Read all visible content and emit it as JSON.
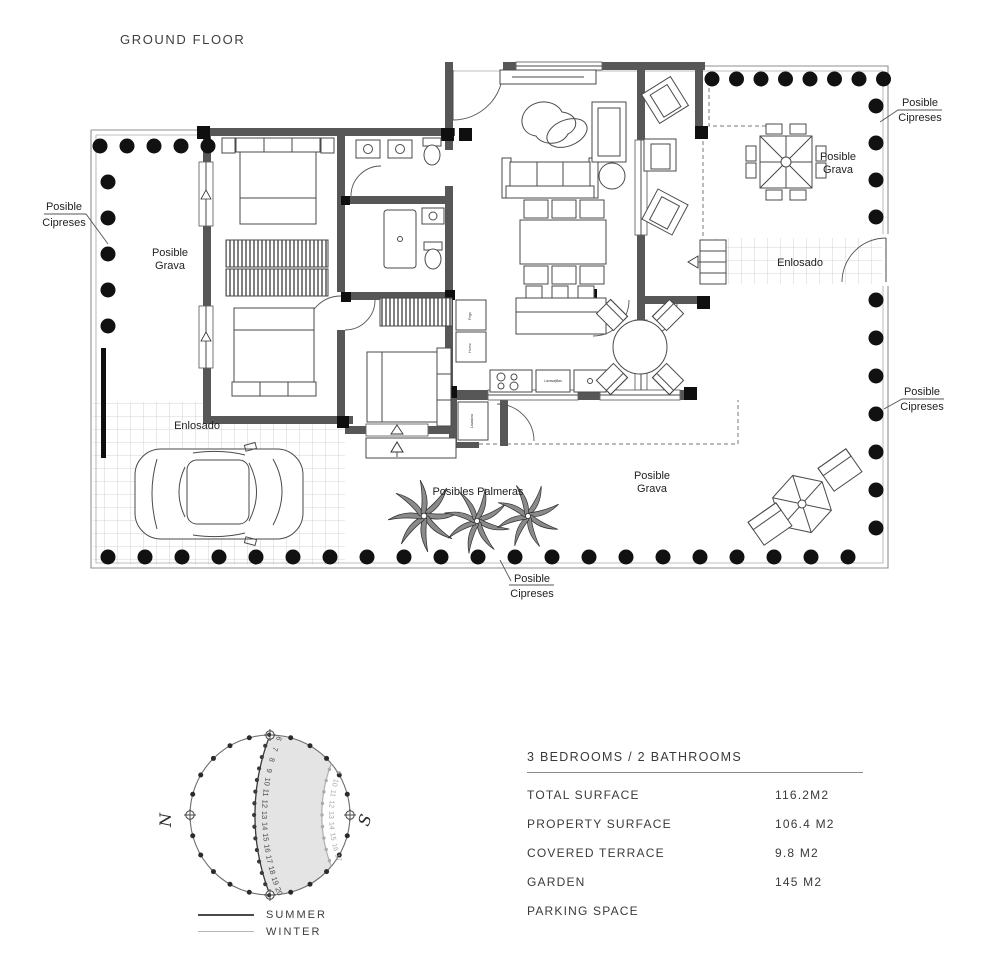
{
  "title": "GROUND FLOOR",
  "plan": {
    "labels": {
      "cipreses_left": [
        "Posible",
        "Cipreses"
      ],
      "grava_left": [
        "Posible",
        "Grava"
      ],
      "cipreses_top_right": [
        "Posible",
        "Cipreses"
      ],
      "grava_top_right": [
        "Posible",
        "Grava"
      ],
      "enlosado_walkway": "Enlosado",
      "cipreses_right": [
        "Posible",
        "Cipreses"
      ],
      "grava_bottom": [
        "Posible",
        "Grava"
      ],
      "palmeras": "Posibles Palmeras",
      "enlosado_parking": "Enlosado",
      "cipreses_bottom": [
        "Posible",
        "Cipreses"
      ]
    },
    "appliances": {
      "fridge": "Frigo",
      "oven": "Horno",
      "washer": "Lavadora",
      "dishwasher": "Lavavajillas"
    }
  },
  "sun_diagram": {
    "north": "N",
    "south": "S",
    "summer_hours": [
      6,
      7,
      8,
      9,
      10,
      11,
      12,
      13,
      14,
      15,
      16,
      17,
      18,
      19,
      20
    ],
    "winter_hours": [
      9,
      10,
      11,
      12,
      13,
      14,
      15,
      16,
      17
    ],
    "legend": [
      {
        "label": "SUMMER",
        "color": "#4a4a4a"
      },
      {
        "label": "WINTER",
        "color": "#b5b5b5"
      }
    ]
  },
  "specs": {
    "title": "3 BEDROOMS / 2 BATHROOMS",
    "rows": [
      {
        "label": "TOTAL SURFACE",
        "value": "116.2M2"
      },
      {
        "label": "PROPERTY SURFACE",
        "value": "106.4 M2"
      },
      {
        "label": "COVERED TERRACE",
        "value": "9.8 M2"
      },
      {
        "label": "GARDEN",
        "value": "145 M2"
      },
      {
        "label": "PARKING SPACE",
        "value": ""
      }
    ]
  },
  "colors": {
    "wall": "#575757",
    "dot": "#111111",
    "boundary": "#8f8f8f",
    "shade": "#e4e4e4",
    "text": "#3d3d3d"
  }
}
